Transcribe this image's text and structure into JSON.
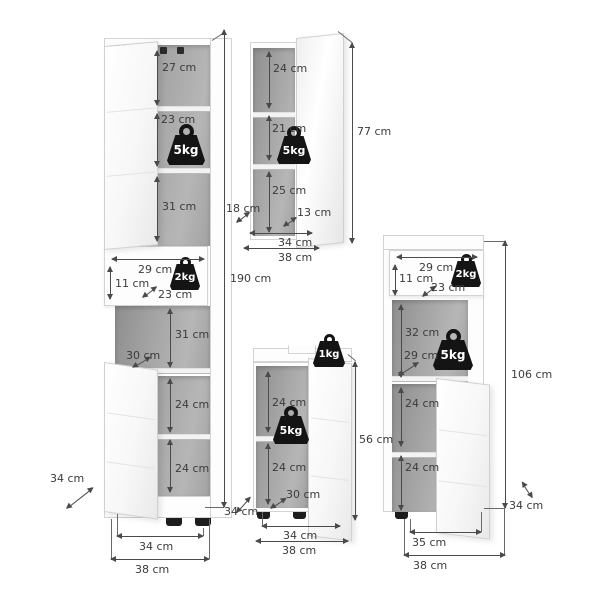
{
  "units": "cm",
  "colors": {
    "background": "#ffffff",
    "dimension_line": "#4a4a4a",
    "interior_gray": "#a2a2a2",
    "weight_black": "#141414",
    "panel_white": "#fdfdfd"
  },
  "cabinets": {
    "tall": {
      "height": "190 cm",
      "c27": "27 cm",
      "c23": "23 cm",
      "c31a": "31 cm",
      "drawer_w": "29 cm",
      "drawer_h": "11 cm",
      "drawer_d": "23 cm",
      "c31b": "31 cm",
      "d30": "30 cm",
      "c24a": "24 cm",
      "c24b": "24 cm",
      "depth": "34 cm",
      "w_in": "34 cm",
      "w_out": "38 cm",
      "load1": "5kg",
      "load2": "2kg"
    },
    "mirror": {
      "height": "77 cm",
      "c24": "24 cm",
      "c21": "21 cm",
      "c25": "25 cm",
      "d13": "13 cm",
      "depth": "18 cm",
      "w_in": "34 cm",
      "w_out": "38 cm",
      "load1": "5kg"
    },
    "sink": {
      "height": "56 cm",
      "c24a": "24 cm",
      "c24b": "24 cm",
      "d30": "30 cm",
      "depth": "34 cm",
      "w_in": "34 cm",
      "w_out": "38 cm",
      "load_top": "1kg",
      "load1": "5kg"
    },
    "midi": {
      "height": "106 cm",
      "drawer_w": "29 cm",
      "drawer_h": "11 cm",
      "drawer_d": "23 cm",
      "c32": "32 cm",
      "d29": "29 cm",
      "c24a": "24 cm",
      "c24b": "24 cm",
      "depth": "34 cm",
      "w_in": "35 cm",
      "w_out": "38 cm",
      "load1": "5kg",
      "load2": "2kg"
    }
  }
}
